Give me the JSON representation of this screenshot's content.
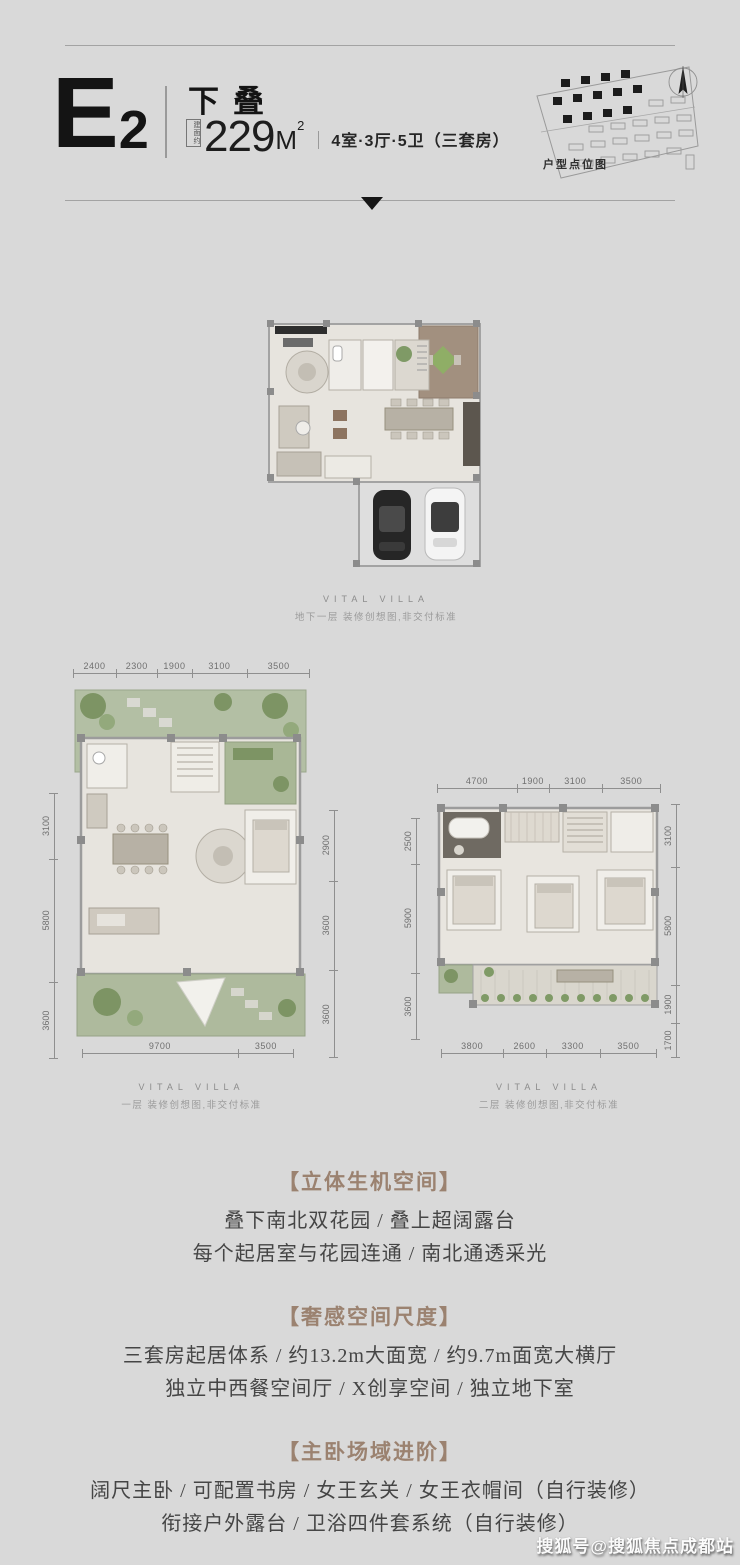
{
  "colors": {
    "background": "#d9d9d9",
    "accent_brown": "#9b8270",
    "text_dark": "#141414",
    "dim_gray": "#6f6f6f"
  },
  "header": {
    "unit_letter": "E",
    "unit_number": "2",
    "type_name": "下叠",
    "area_prefix": "建面约",
    "area_value": "229",
    "area_unit": "M",
    "area_sup": "2",
    "layout_desc": "4室·3厅·5卫（三套房）",
    "site_map_label": "户型点位图"
  },
  "plans": [
    {
      "id": "basement",
      "brand": "VITAL VILLA",
      "caption": "地下一层 装修创想图,非交付标准"
    },
    {
      "id": "first-floor",
      "brand": "VITAL VILLA",
      "caption": "一层 装修创想图,非交付标准",
      "dims_top": [
        "2400",
        "2300",
        "1900",
        "3100",
        "3500"
      ],
      "dims_left": [
        "3100",
        "5800",
        "3600"
      ],
      "dims_right": [
        "2900",
        "3600",
        "3600"
      ],
      "dims_bottom": [
        "9700",
        "3500"
      ]
    },
    {
      "id": "second-floor",
      "brand": "VITAL VILLA",
      "caption": "二层 装修创想图,非交付标准",
      "dims_top": [
        "4700",
        "1900",
        "3100",
        "3500"
      ],
      "dims_left": [
        "2500",
        "5900",
        "3600"
      ],
      "dims_right": [
        "3100",
        "5800",
        "1900",
        "1700"
      ],
      "dims_bottom": [
        "3800",
        "2600",
        "3300",
        "3500"
      ]
    }
  ],
  "sections": [
    {
      "title": "【立体生机空间】",
      "lines": [
        "叠下南北双花园  /  叠上超阔露台",
        "每个起居室与花园连通  /  南北通透采光"
      ]
    },
    {
      "title": "【奢感空间尺度】",
      "lines": [
        "三套房起居体系 / 约13.2m大面宽 / 约9.7m面宽大横厅",
        "独立中西餐空间厅 / X创享空间 / 独立地下室"
      ]
    },
    {
      "title": "【主卧场域进阶】",
      "lines": [
        "阔尺主卧 / 可配置书房 / 女王玄关 / 女王衣帽间（自行装修）",
        "衔接户外露台 / 卫浴四件套系统（自行装修）"
      ]
    }
  ],
  "watermark": "搜狐号@搜狐焦点成都站"
}
